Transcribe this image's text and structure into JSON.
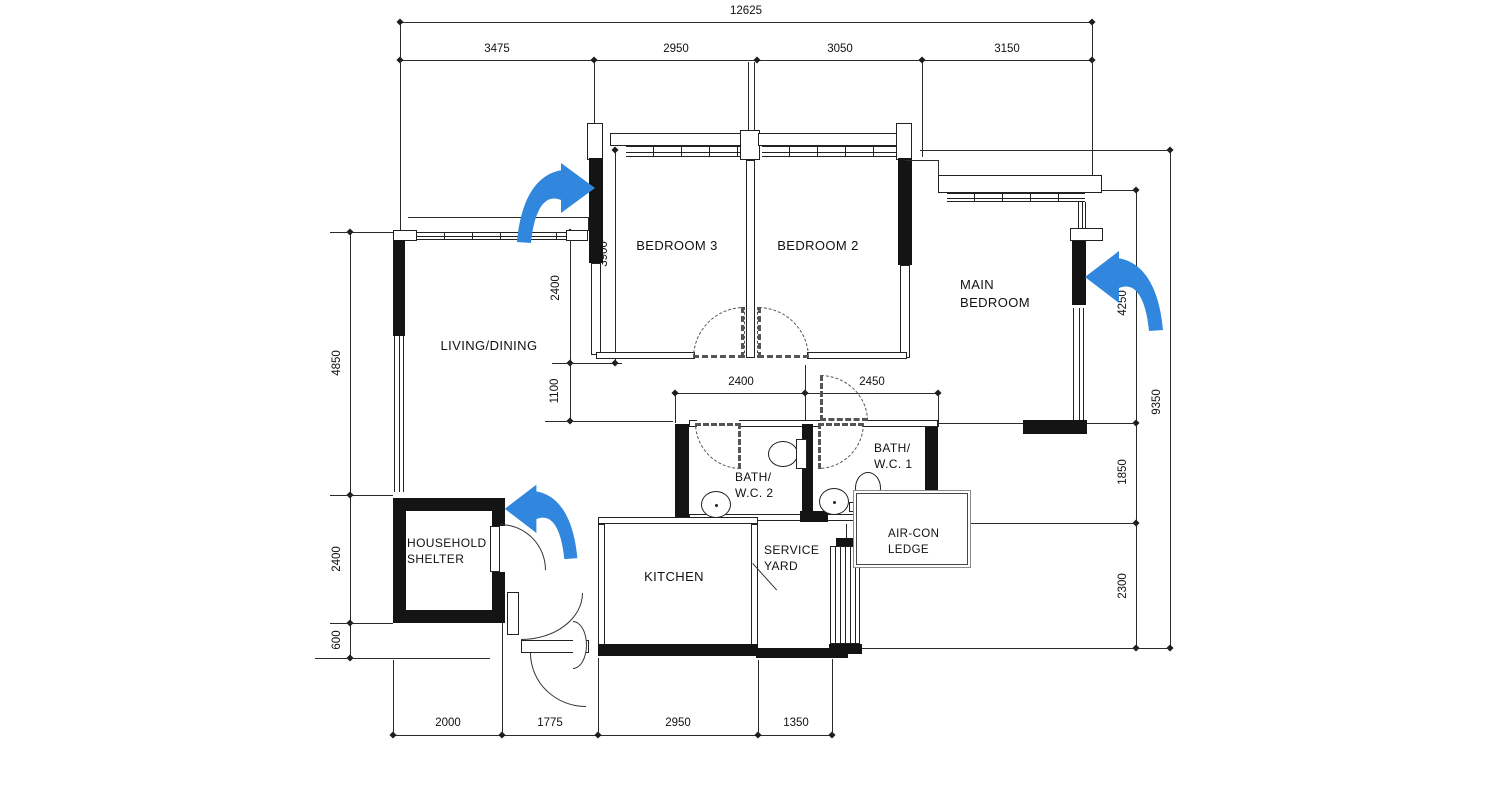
{
  "rooms": {
    "living_dining": "LIVING/DINING",
    "bedroom3": "BEDROOM 3",
    "bedroom2": "BEDROOM 2",
    "main_bedroom": [
      "MAIN",
      "BEDROOM"
    ],
    "bath_wc2": [
      "BATH/",
      "W.C. 2"
    ],
    "bath_wc1": [
      "BATH/",
      "W.C. 1"
    ],
    "household_shelter": [
      "HOUSEHOLD",
      "SHELTER"
    ],
    "kitchen": "KITCHEN",
    "service_yard": [
      "SERVICE",
      "YARD"
    ],
    "aircon_ledge": [
      "AIR-CON",
      "LEDGE"
    ]
  },
  "dimensions": {
    "top_overall": "12625",
    "top_segments": [
      "3475",
      "2950",
      "3050",
      "3150"
    ],
    "left_column": [
      "4850",
      "2400",
      "600"
    ],
    "living_depth": "2400",
    "hall_depth": "1100",
    "bedroom3_depth": "3900",
    "bath2_width": "2400",
    "bath1_width": "2450",
    "right_column": [
      "4250",
      "1850",
      "2300"
    ],
    "right_overall": "9350",
    "bottom_segments": [
      "2000",
      "1775",
      "2950",
      "1350"
    ]
  },
  "annotations": {
    "arrow_color": "#3186DD",
    "arrows": [
      {
        "id": "arrow-bedroom3-wall",
        "direction": "right"
      },
      {
        "id": "arrow-main-bedroom-wall",
        "direction": "left"
      },
      {
        "id": "arrow-household-shelter",
        "direction": "left"
      }
    ]
  }
}
